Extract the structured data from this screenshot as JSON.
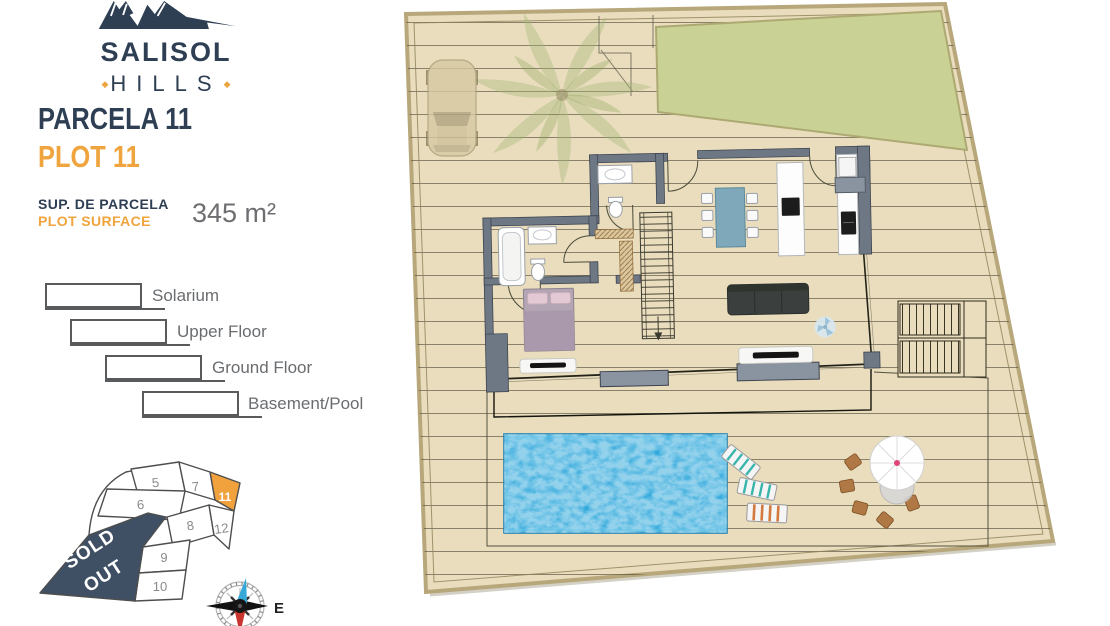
{
  "brand": {
    "name": "SALISOL",
    "sub": "HILLS"
  },
  "header": {
    "parcela": "PARCELA 11",
    "plot": "PLOT 11",
    "surface_label_es": "SUP. DE PARCELA",
    "surface_label_en": "PLOT SURFACE",
    "surface_value": "345 m²"
  },
  "legend": {
    "items": [
      {
        "label": "Solarium"
      },
      {
        "label": "Upper Floor"
      },
      {
        "label": "Ground Floor"
      },
      {
        "label": "Basement/Pool"
      }
    ]
  },
  "minimap": {
    "highlighted_plot": "11",
    "sold_line1": "SOLD",
    "sold_line2": "OUT",
    "plots": [
      {
        "id": "5"
      },
      {
        "id": "7"
      },
      {
        "id": "11"
      },
      {
        "id": "6"
      },
      {
        "id": "8"
      },
      {
        "id": "12"
      },
      {
        "id": "9"
      },
      {
        "id": "10"
      }
    ]
  },
  "compass": {
    "east_label": "E"
  },
  "colors": {
    "navy": "#2e3e53",
    "orange": "#efa43d",
    "text_gray": "#6d6e71",
    "plot_beige": "#e9ddbd",
    "lawn_green": "#c9d194",
    "wall_gray": "#6e7885",
    "pool_blue": "#2aa7dc",
    "sold_navy": "#3f5064",
    "plot11_orange": "#f2a23d"
  }
}
